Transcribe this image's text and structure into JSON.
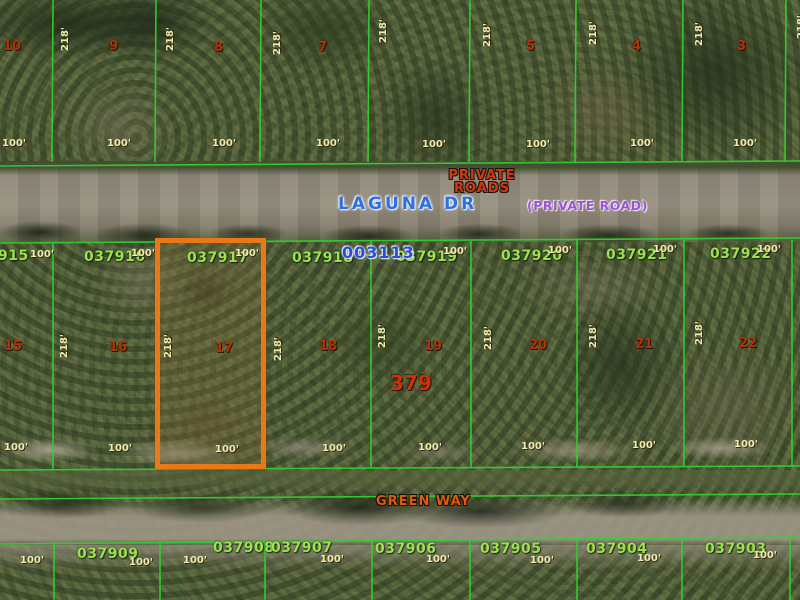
{
  "parcel_map": {
    "boundary_color": "#2fd32f",
    "highlight_color": "#e87818",
    "highlighted_parcel": "037917",
    "streets": {
      "laguna_dr": "LAGUNA DR",
      "private_line1": "PRIVATE",
      "private_line2": "ROADS",
      "private_road_paren": "(PRIVATE ROAD)",
      "green_way": "GREEN WAY"
    },
    "annotations": {
      "blue_plat_id": "003113",
      "block_number": "379"
    },
    "dims": {
      "depth": "218'",
      "width": "100'"
    },
    "top_row": {
      "lot_numbers": [
        "10",
        "9",
        "8",
        "7",
        "5",
        "4",
        "3"
      ]
    },
    "middle_row": {
      "parcel_ids": [
        "915",
        "037916",
        "037917",
        "037918",
        "037919",
        "037920",
        "037921",
        "037922"
      ],
      "lot_numbers": [
        "15",
        "16",
        "17",
        "18",
        "19",
        "20",
        "21",
        "22"
      ]
    },
    "bottom_row": {
      "parcel_ids": [
        "037909",
        "037908",
        "037907",
        "037906",
        "037905",
        "037904",
        "037903"
      ]
    }
  }
}
